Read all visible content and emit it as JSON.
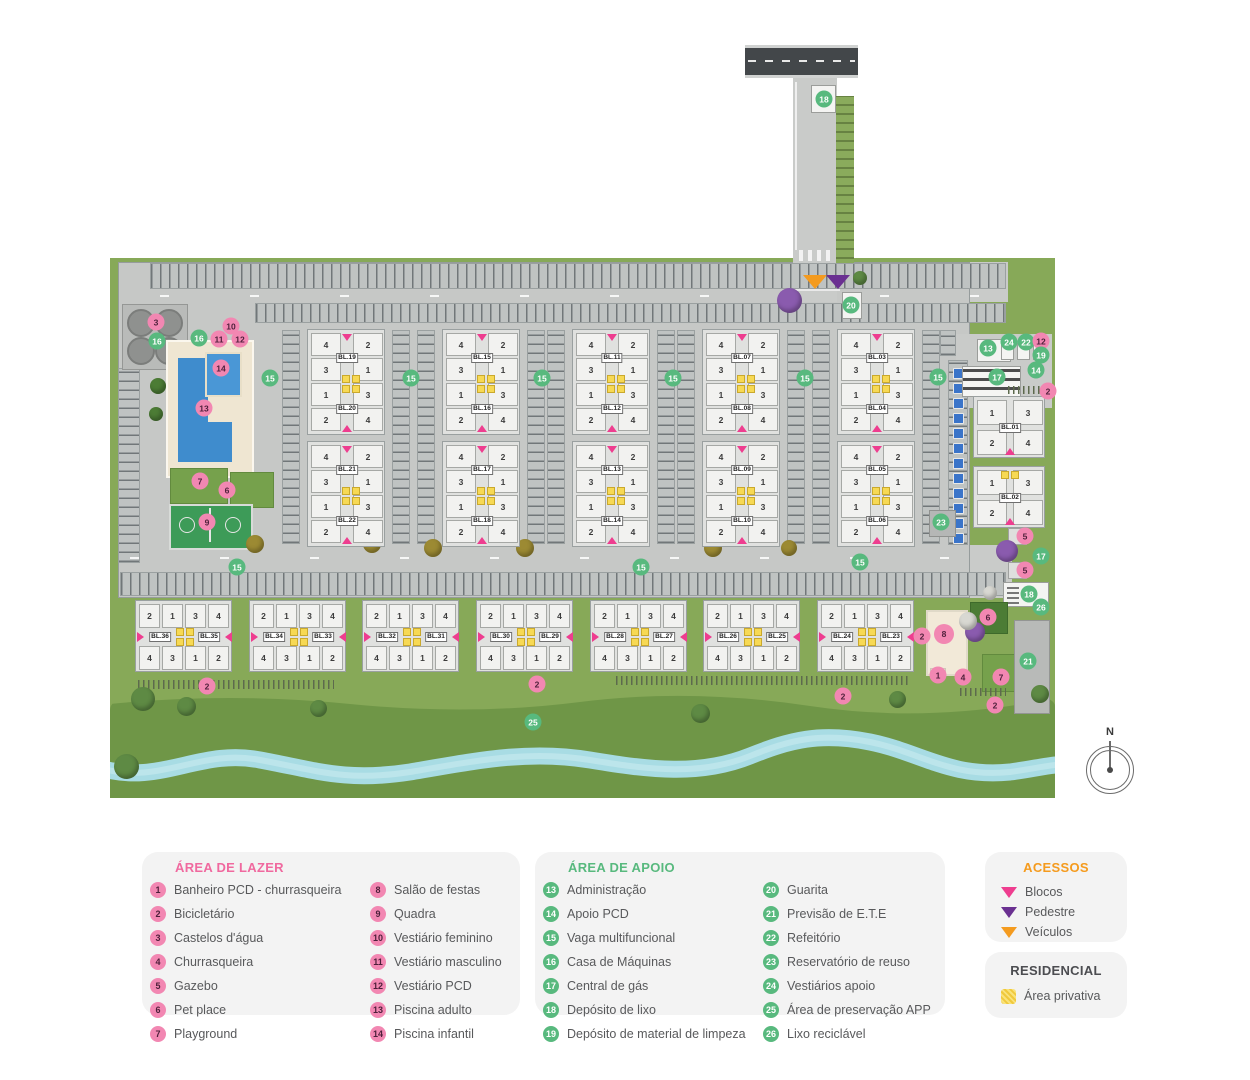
{
  "colors": {
    "pink_badge": "#f287b2",
    "green_badge": "#58b97e",
    "accent_pink": "#ee3d8f",
    "accent_purple": "#6a3091",
    "accent_orange": "#f49b1f",
    "private_yellow": "#f7d954",
    "river": "#a8dce4",
    "grass": "#87a958",
    "grass_preservation": "#6f9647",
    "pavement": "#c6c8c6",
    "road": "#43474a",
    "pool_blue": "#3f8ccd"
  },
  "compass": {
    "label": "N"
  },
  "legend": {
    "lazer": {
      "title": "ÁREA DE LAZER",
      "items": [
        {
          "n": "1",
          "label": "Banheiro PCD -  churrasqueira"
        },
        {
          "n": "2",
          "label": "Bicicletário"
        },
        {
          "n": "3",
          "label": "Castelos d'água"
        },
        {
          "n": "4",
          "label": "Churrasqueira"
        },
        {
          "n": "5",
          "label": "Gazebo"
        },
        {
          "n": "6",
          "label": "Pet place"
        },
        {
          "n": "7",
          "label": "Playground"
        },
        {
          "n": "8",
          "label": "Salão de festas"
        },
        {
          "n": "9",
          "label": "Quadra"
        },
        {
          "n": "10",
          "label": "Vestiário feminino"
        },
        {
          "n": "11",
          "label": "Vestiário masculino"
        },
        {
          "n": "12",
          "label": "Vestiário PCD"
        },
        {
          "n": "13",
          "label": "Piscina adulto"
        },
        {
          "n": "14",
          "label": "Piscina infantil"
        }
      ]
    },
    "apoio": {
      "title": "ÁREA DE APOIO",
      "items": [
        {
          "n": "13",
          "label": "Administração"
        },
        {
          "n": "14",
          "label": "Apoio PCD"
        },
        {
          "n": "15",
          "label": "Vaga multifuncional"
        },
        {
          "n": "16",
          "label": "Casa de Máquinas"
        },
        {
          "n": "17",
          "label": "Central de gás"
        },
        {
          "n": "18",
          "label": "Depósito de lixo"
        },
        {
          "n": "19",
          "label": "Depósito de material de limpeza"
        },
        {
          "n": "20",
          "label": "Guarita"
        },
        {
          "n": "21",
          "label": "Previsão de E.T.E"
        },
        {
          "n": "22",
          "label": "Refeitório"
        },
        {
          "n": "23",
          "label": "Reservatório de reuso"
        },
        {
          "n": "24",
          "label": "Vestiários apoio"
        },
        {
          "n": "25",
          "label": "Área de preservação APP"
        },
        {
          "n": "26",
          "label": "Lixo reciclável"
        }
      ]
    },
    "acessos": {
      "title": "ACESSOS",
      "items": [
        {
          "label": "Blocos",
          "color": "#ee3d8f"
        },
        {
          "label": "Pedestre",
          "color": "#6a3091"
        },
        {
          "label": "Veículos",
          "color": "#f49b1f"
        }
      ]
    },
    "residencial": {
      "title": "RESIDENCIAL",
      "item": "Área privativa"
    }
  },
  "plan": {
    "unit_numbers": {
      "v_left": [
        "4",
        "3",
        "1",
        "2"
      ],
      "v_right": [
        "2",
        "1",
        "3",
        "4"
      ],
      "h_top": [
        "2",
        "1",
        "3",
        "4"
      ],
      "h_bottom": [
        "4",
        "3",
        "1",
        "2"
      ],
      "r_rows": [
        [
          "1",
          "3"
        ],
        [
          "2",
          "4"
        ]
      ]
    },
    "v_clusters": [
      {
        "x": 307,
        "y": 329,
        "labels": [
          "BL.19",
          "BL.20"
        ]
      },
      {
        "x": 307,
        "y": 441,
        "labels": [
          "BL.21",
          "BL.22"
        ]
      },
      {
        "x": 442,
        "y": 329,
        "labels": [
          "BL.15",
          "BL.16"
        ]
      },
      {
        "x": 442,
        "y": 441,
        "labels": [
          "BL.17",
          "BL.18"
        ]
      },
      {
        "x": 572,
        "y": 329,
        "labels": [
          "BL.11",
          "BL.12"
        ]
      },
      {
        "x": 572,
        "y": 441,
        "labels": [
          "BL.13",
          "BL.14"
        ]
      },
      {
        "x": 702,
        "y": 329,
        "labels": [
          "BL.07",
          "BL.08"
        ]
      },
      {
        "x": 702,
        "y": 441,
        "labels": [
          "BL.09",
          "BL.10"
        ]
      },
      {
        "x": 837,
        "y": 329,
        "labels": [
          "BL.03",
          "BL.04"
        ]
      },
      {
        "x": 837,
        "y": 441,
        "labels": [
          "BL.05",
          "BL.06"
        ]
      }
    ],
    "h_clusters": [
      {
        "x": 135,
        "y": 600,
        "labels": [
          "BL.36",
          "BL.35"
        ]
      },
      {
        "x": 249,
        "y": 600,
        "labels": [
          "BL.34",
          "BL.33"
        ]
      },
      {
        "x": 362,
        "y": 600,
        "labels": [
          "BL.32",
          "BL.31"
        ]
      },
      {
        "x": 476,
        "y": 600,
        "labels": [
          "BL.30",
          "BL.29"
        ]
      },
      {
        "x": 590,
        "y": 600,
        "labels": [
          "BL.28",
          "BL.27"
        ]
      },
      {
        "x": 703,
        "y": 600,
        "labels": [
          "BL.26",
          "BL.25"
        ]
      },
      {
        "x": 817,
        "y": 600,
        "labels": [
          "BL.24",
          "BL.23"
        ]
      }
    ],
    "r_clusters": [
      {
        "x": 973,
        "y": 396,
        "label": "BL.01",
        "yellow": false
      },
      {
        "x": 973,
        "y": 466,
        "label": "BL.02",
        "yellow": true
      }
    ],
    "markers": [
      {
        "n": "3",
        "c": "pink",
        "x": 156,
        "y": 322
      },
      {
        "n": "16",
        "c": "green",
        "x": 157,
        "y": 341
      },
      {
        "n": "16",
        "c": "green",
        "x": 199,
        "y": 338
      },
      {
        "n": "10",
        "c": "pink",
        "x": 231,
        "y": 326
      },
      {
        "n": "11",
        "c": "pink",
        "x": 219,
        "y": 339
      },
      {
        "n": "12",
        "c": "pink",
        "x": 240,
        "y": 339
      },
      {
        "n": "14",
        "c": "pink",
        "x": 221,
        "y": 368
      },
      {
        "n": "13",
        "c": "pink",
        "x": 204,
        "y": 408
      },
      {
        "n": "7",
        "c": "pink",
        "x": 200,
        "y": 481
      },
      {
        "n": "6",
        "c": "pink",
        "x": 227,
        "y": 490
      },
      {
        "n": "9",
        "c": "pink",
        "x": 207,
        "y": 522
      },
      {
        "n": "15",
        "c": "green",
        "x": 270,
        "y": 378
      },
      {
        "n": "15",
        "c": "green",
        "x": 411,
        "y": 378
      },
      {
        "n": "15",
        "c": "green",
        "x": 542,
        "y": 378
      },
      {
        "n": "15",
        "c": "green",
        "x": 673,
        "y": 378
      },
      {
        "n": "15",
        "c": "green",
        "x": 805,
        "y": 378
      },
      {
        "n": "15",
        "c": "green",
        "x": 938,
        "y": 377
      },
      {
        "n": "15",
        "c": "green",
        "x": 237,
        "y": 567
      },
      {
        "n": "15",
        "c": "green",
        "x": 641,
        "y": 567
      },
      {
        "n": "15",
        "c": "green",
        "x": 860,
        "y": 562
      },
      {
        "n": "18",
        "c": "green",
        "x": 824,
        "y": 99
      },
      {
        "n": "20",
        "c": "green",
        "x": 851,
        "y": 305
      },
      {
        "n": "13",
        "c": "green",
        "x": 988,
        "y": 348
      },
      {
        "n": "24",
        "c": "green",
        "x": 1009,
        "y": 342
      },
      {
        "n": "22",
        "c": "green",
        "x": 1026,
        "y": 342
      },
      {
        "n": "12",
        "c": "pink",
        "x": 1041,
        "y": 341
      },
      {
        "n": "19",
        "c": "green",
        "x": 1041,
        "y": 355
      },
      {
        "n": "17",
        "c": "green",
        "x": 997,
        "y": 377
      },
      {
        "n": "14",
        "c": "green",
        "x": 1036,
        "y": 370
      },
      {
        "n": "2",
        "c": "pink",
        "x": 1048,
        "y": 391
      },
      {
        "n": "23",
        "c": "green",
        "x": 941,
        "y": 522
      },
      {
        "n": "5",
        "c": "pink",
        "x": 1025,
        "y": 536
      },
      {
        "n": "17",
        "c": "green",
        "x": 1041,
        "y": 556
      },
      {
        "n": "5",
        "c": "pink",
        "x": 1025,
        "y": 570
      },
      {
        "n": "18",
        "c": "green",
        "x": 1029,
        "y": 594
      },
      {
        "n": "26",
        "c": "green",
        "x": 1041,
        "y": 607
      },
      {
        "n": "6",
        "c": "pink",
        "x": 988,
        "y": 617
      },
      {
        "n": "2",
        "c": "pink",
        "x": 922,
        "y": 636
      },
      {
        "n": "8",
        "c": "pink",
        "x": 944,
        "y": 634,
        "s": 20
      },
      {
        "n": "1",
        "c": "pink",
        "x": 938,
        "y": 675
      },
      {
        "n": "4",
        "c": "pink",
        "x": 963,
        "y": 677
      },
      {
        "n": "7",
        "c": "pink",
        "x": 1001,
        "y": 677
      },
      {
        "n": "21",
        "c": "green",
        "x": 1028,
        "y": 661
      },
      {
        "n": "2",
        "c": "pink",
        "x": 995,
        "y": 705
      },
      {
        "n": "2",
        "c": "pink",
        "x": 207,
        "y": 686
      },
      {
        "n": "2",
        "c": "pink",
        "x": 537,
        "y": 684
      },
      {
        "n": "2",
        "c": "pink",
        "x": 843,
        "y": 696
      },
      {
        "n": "25",
        "c": "green",
        "x": 533,
        "y": 722
      }
    ],
    "access_points": [
      {
        "type": "veiculos-access",
        "color": "#f49b1f",
        "x": 815,
        "y": 283
      },
      {
        "type": "pedestre-access",
        "color": "#6a3091",
        "x": 838,
        "y": 283
      }
    ]
  }
}
